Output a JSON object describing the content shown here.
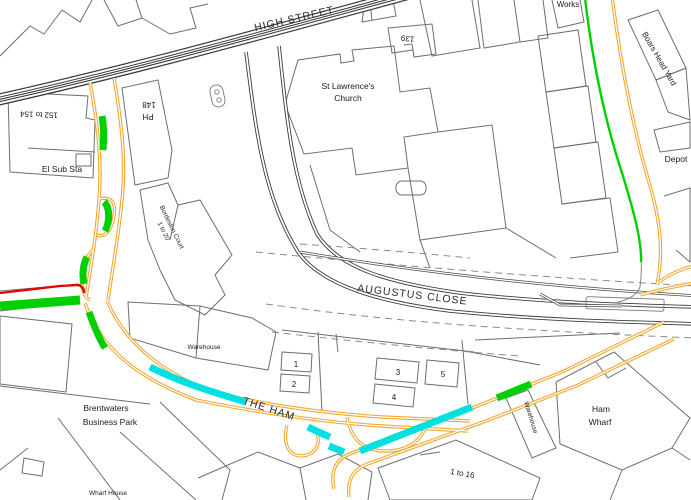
{
  "map": {
    "streets": {
      "high_street": "HIGH STREET",
      "augustus_close": "AUGUSTUS CLOSE",
      "the_ham": "THE HAM"
    },
    "places": {
      "st_lawrences_line1": "St Lawrence's",
      "st_lawrences_line2": "Church",
      "num_139": "139",
      "works": "Works",
      "boars_head_yard": "Boars Head Yard",
      "depot": "Depot",
      "num_148": "148",
      "ph": "PH",
      "num_152_154": "152 to 154",
      "el_sub_sta": "El Sub Sta",
      "bordeston_line1": "Bordeston Court",
      "bordeston_line2": "1 to 20",
      "warehouse_center": "Warehouse",
      "warehouse_east": "Warehouse",
      "brentwaters_line1": "Brentwaters",
      "brentwaters_line2": "Business Park",
      "ham_wharf_line1": "Ham",
      "ham_wharf_line2": "Wharf",
      "one_to_16": "1 to 16",
      "wharf_house": "Wharf House"
    },
    "plots": [
      "1",
      "2",
      "3",
      "4",
      "5"
    ],
    "colors": {
      "double_yellow": "#F0A830",
      "green_marking": "#00D000",
      "cyan_marking": "#00E0E0",
      "red_marking": "#E60000",
      "building_line": "#6E6E6E",
      "road_casing": "#3A3A3A",
      "background": "#FFFFFF"
    }
  }
}
